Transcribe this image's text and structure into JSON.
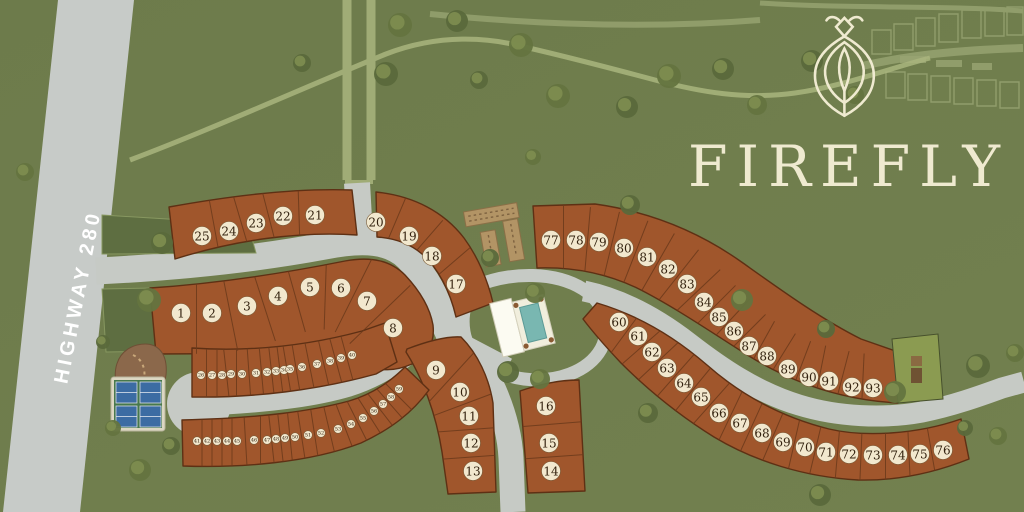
{
  "logo": {
    "text": "FIREFLY",
    "icon": "firefly-icon"
  },
  "highway": {
    "label": "HIGHWAY 280"
  },
  "colors": {
    "background_green": "#6f7d4d",
    "lot_rust": "#a0562c",
    "lot_outline": "#5e3014",
    "road_gray": "#c6cac5",
    "badge_cream": "#f2e8ce",
    "logo_cream": "#efead0",
    "median_green": "#5e6e41",
    "pool_teal": "#79b7b1",
    "court_blue": "#3c6ca3",
    "garden_tan": "#b29465",
    "dog_park_brown": "#8b684b",
    "ghost_olive": "#9fae76"
  },
  "amenities": {
    "pool_clubhouse": "clubhouse-pool",
    "pickleball_courts": "pickleball-courts",
    "community_garden": "community-garden",
    "dog_park": "dog-park",
    "barn_lot": "barn-lot",
    "cul_de_sac": "cul-de-sac"
  },
  "lots": {
    "large": [
      {
        "n": 1,
        "x": 181,
        "y": 313
      },
      {
        "n": 2,
        "x": 212,
        "y": 313
      },
      {
        "n": 3,
        "x": 247,
        "y": 306
      },
      {
        "n": 4,
        "x": 278,
        "y": 296
      },
      {
        "n": 5,
        "x": 310,
        "y": 287
      },
      {
        "n": 6,
        "x": 341,
        "y": 288
      },
      {
        "n": 7,
        "x": 367,
        "y": 301
      },
      {
        "n": 8,
        "x": 393,
        "y": 328
      },
      {
        "n": 9,
        "x": 436,
        "y": 370
      },
      {
        "n": 10,
        "x": 460,
        "y": 392
      },
      {
        "n": 11,
        "x": 469,
        "y": 416
      },
      {
        "n": 12,
        "x": 471,
        "y": 443
      },
      {
        "n": 13,
        "x": 473,
        "y": 471
      },
      {
        "n": 14,
        "x": 551,
        "y": 471
      },
      {
        "n": 15,
        "x": 549,
        "y": 443
      },
      {
        "n": 16,
        "x": 546,
        "y": 406
      },
      {
        "n": 17,
        "x": 456,
        "y": 284
      },
      {
        "n": 18,
        "x": 432,
        "y": 256
      },
      {
        "n": 19,
        "x": 409,
        "y": 236
      },
      {
        "n": 20,
        "x": 376,
        "y": 222
      },
      {
        "n": 21,
        "x": 315,
        "y": 215
      },
      {
        "n": 22,
        "x": 283,
        "y": 216
      },
      {
        "n": 23,
        "x": 256,
        "y": 223
      },
      {
        "n": 24,
        "x": 229,
        "y": 231
      },
      {
        "n": 25,
        "x": 202,
        "y": 236
      },
      {
        "n": 60,
        "x": 619,
        "y": 322
      },
      {
        "n": 61,
        "x": 638,
        "y": 336
      },
      {
        "n": 62,
        "x": 652,
        "y": 352
      },
      {
        "n": 63,
        "x": 667,
        "y": 368
      },
      {
        "n": 64,
        "x": 684,
        "y": 383
      },
      {
        "n": 65,
        "x": 701,
        "y": 397
      },
      {
        "n": 66,
        "x": 719,
        "y": 413
      },
      {
        "n": 67,
        "x": 740,
        "y": 423
      },
      {
        "n": 68,
        "x": 762,
        "y": 433
      },
      {
        "n": 69,
        "x": 783,
        "y": 442
      },
      {
        "n": 70,
        "x": 805,
        "y": 447
      },
      {
        "n": 71,
        "x": 826,
        "y": 452
      },
      {
        "n": 72,
        "x": 849,
        "y": 454
      },
      {
        "n": 73,
        "x": 873,
        "y": 455
      },
      {
        "n": 74,
        "x": 898,
        "y": 455
      },
      {
        "n": 75,
        "x": 920,
        "y": 454
      },
      {
        "n": 76,
        "x": 943,
        "y": 450
      },
      {
        "n": 77,
        "x": 551,
        "y": 240
      },
      {
        "n": 78,
        "x": 576,
        "y": 240
      },
      {
        "n": 79,
        "x": 599,
        "y": 242
      },
      {
        "n": 80,
        "x": 624,
        "y": 248
      },
      {
        "n": 81,
        "x": 647,
        "y": 257
      },
      {
        "n": 82,
        "x": 668,
        "y": 269
      },
      {
        "n": 83,
        "x": 687,
        "y": 284
      },
      {
        "n": 84,
        "x": 704,
        "y": 302
      },
      {
        "n": 85,
        "x": 719,
        "y": 317
      },
      {
        "n": 86,
        "x": 734,
        "y": 331
      },
      {
        "n": 87,
        "x": 749,
        "y": 346
      },
      {
        "n": 88,
        "x": 767,
        "y": 356
      },
      {
        "n": 89,
        "x": 788,
        "y": 369
      },
      {
        "n": 90,
        "x": 809,
        "y": 377
      },
      {
        "n": 91,
        "x": 829,
        "y": 381
      },
      {
        "n": 92,
        "x": 852,
        "y": 387
      },
      {
        "n": 93,
        "x": 873,
        "y": 388
      }
    ],
    "small": [
      {
        "n": 26,
        "x": 201,
        "y": 375
      },
      {
        "n": 27,
        "x": 212,
        "y": 375
      },
      {
        "n": 28,
        "x": 222,
        "y": 375
      },
      {
        "n": 29,
        "x": 231,
        "y": 374
      },
      {
        "n": 30,
        "x": 242,
        "y": 374
      },
      {
        "n": 31,
        "x": 256,
        "y": 373
      },
      {
        "n": 32,
        "x": 267,
        "y": 372
      },
      {
        "n": 33,
        "x": 276,
        "y": 371
      },
      {
        "n": 34,
        "x": 284,
        "y": 370
      },
      {
        "n": 35,
        "x": 290,
        "y": 369
      },
      {
        "n": 36,
        "x": 302,
        "y": 367
      },
      {
        "n": 37,
        "x": 317,
        "y": 364
      },
      {
        "n": 38,
        "x": 330,
        "y": 361
      },
      {
        "n": 39,
        "x": 341,
        "y": 358
      },
      {
        "n": 40,
        "x": 352,
        "y": 355
      },
      {
        "n": 41,
        "x": 197,
        "y": 441
      },
      {
        "n": 42,
        "x": 207,
        "y": 441
      },
      {
        "n": 43,
        "x": 217,
        "y": 441
      },
      {
        "n": 44,
        "x": 227,
        "y": 441
      },
      {
        "n": 45,
        "x": 237,
        "y": 441
      },
      {
        "n": 46,
        "x": 254,
        "y": 440
      },
      {
        "n": 47,
        "x": 267,
        "y": 440
      },
      {
        "n": 48,
        "x": 276,
        "y": 439
      },
      {
        "n": 49,
        "x": 285,
        "y": 438
      },
      {
        "n": 50,
        "x": 295,
        "y": 437
      },
      {
        "n": 51,
        "x": 308,
        "y": 435
      },
      {
        "n": 52,
        "x": 321,
        "y": 433
      },
      {
        "n": 53,
        "x": 338,
        "y": 429
      },
      {
        "n": 54,
        "x": 351,
        "y": 424
      },
      {
        "n": 55,
        "x": 363,
        "y": 418
      },
      {
        "n": 56,
        "x": 374,
        "y": 411
      },
      {
        "n": 57,
        "x": 383,
        "y": 404
      },
      {
        "n": 58,
        "x": 391,
        "y": 397
      },
      {
        "n": 59,
        "x": 399,
        "y": 389
      }
    ]
  },
  "bands": [
    {
      "id": "A",
      "half": 42,
      "seq": [
        1,
        2,
        3,
        4,
        5,
        6,
        7,
        8
      ]
    },
    {
      "id": "B1",
      "half": 34,
      "seq": [
        25,
        24,
        23,
        22,
        21
      ]
    },
    {
      "id": "B2",
      "half": 34,
      "seq": [
        20,
        19,
        18,
        17
      ]
    },
    {
      "id": "C",
      "half": 40,
      "seq": [
        9,
        10,
        11,
        12,
        13
      ]
    },
    {
      "id": "D",
      "half": 36,
      "seq": [
        16,
        15,
        14
      ]
    },
    {
      "id": "E",
      "half": 34,
      "seq": [
        77,
        78,
        79,
        80,
        81,
        82,
        83,
        84,
        85,
        86,
        87,
        88,
        89,
        90,
        91,
        92,
        93
      ]
    },
    {
      "id": "F",
      "half": 34,
      "seq": [
        60,
        61,
        62,
        63,
        64,
        65,
        66,
        67,
        68,
        69,
        70,
        71,
        72,
        73,
        74,
        75,
        76
      ]
    },
    {
      "id": "G",
      "half": 26,
      "seq": [
        26,
        27,
        28,
        29,
        30,
        31,
        32,
        33,
        34,
        35,
        36,
        37,
        38,
        39,
        40
      ]
    },
    {
      "id": "H",
      "half": 26,
      "seq": [
        41,
        42,
        43,
        44,
        45,
        46,
        47,
        48,
        49,
        50,
        51,
        52,
        53,
        54,
        55,
        56,
        57,
        58,
        59
      ]
    }
  ],
  "trees": [
    [
      386,
      74,
      12
    ],
    [
      400,
      25,
      12
    ],
    [
      457,
      21,
      11
    ],
    [
      521,
      45,
      12
    ],
    [
      479,
      80,
      9
    ],
    [
      558,
      96,
      12
    ],
    [
      627,
      107,
      11
    ],
    [
      669,
      76,
      12
    ],
    [
      723,
      69,
      11
    ],
    [
      757,
      105,
      10
    ],
    [
      812,
      61,
      11
    ],
    [
      855,
      95,
      9
    ],
    [
      302,
      63,
      9
    ],
    [
      25,
      172,
      9
    ],
    [
      162,
      243,
      11
    ],
    [
      149,
      300,
      12
    ],
    [
      103,
      342,
      7
    ],
    [
      113,
      428,
      8
    ],
    [
      171,
      446,
      9
    ],
    [
      140,
      470,
      11
    ],
    [
      490,
      258,
      9
    ],
    [
      535,
      293,
      10
    ],
    [
      508,
      372,
      11
    ],
    [
      540,
      379,
      10
    ],
    [
      630,
      205,
      10
    ],
    [
      533,
      157,
      8
    ],
    [
      648,
      413,
      10
    ],
    [
      742,
      300,
      11
    ],
    [
      826,
      329,
      9
    ],
    [
      895,
      392,
      11
    ],
    [
      978,
      366,
      12
    ],
    [
      1015,
      353,
      9
    ],
    [
      965,
      428,
      8
    ],
    [
      998,
      436,
      9
    ],
    [
      820,
      495,
      11
    ]
  ]
}
